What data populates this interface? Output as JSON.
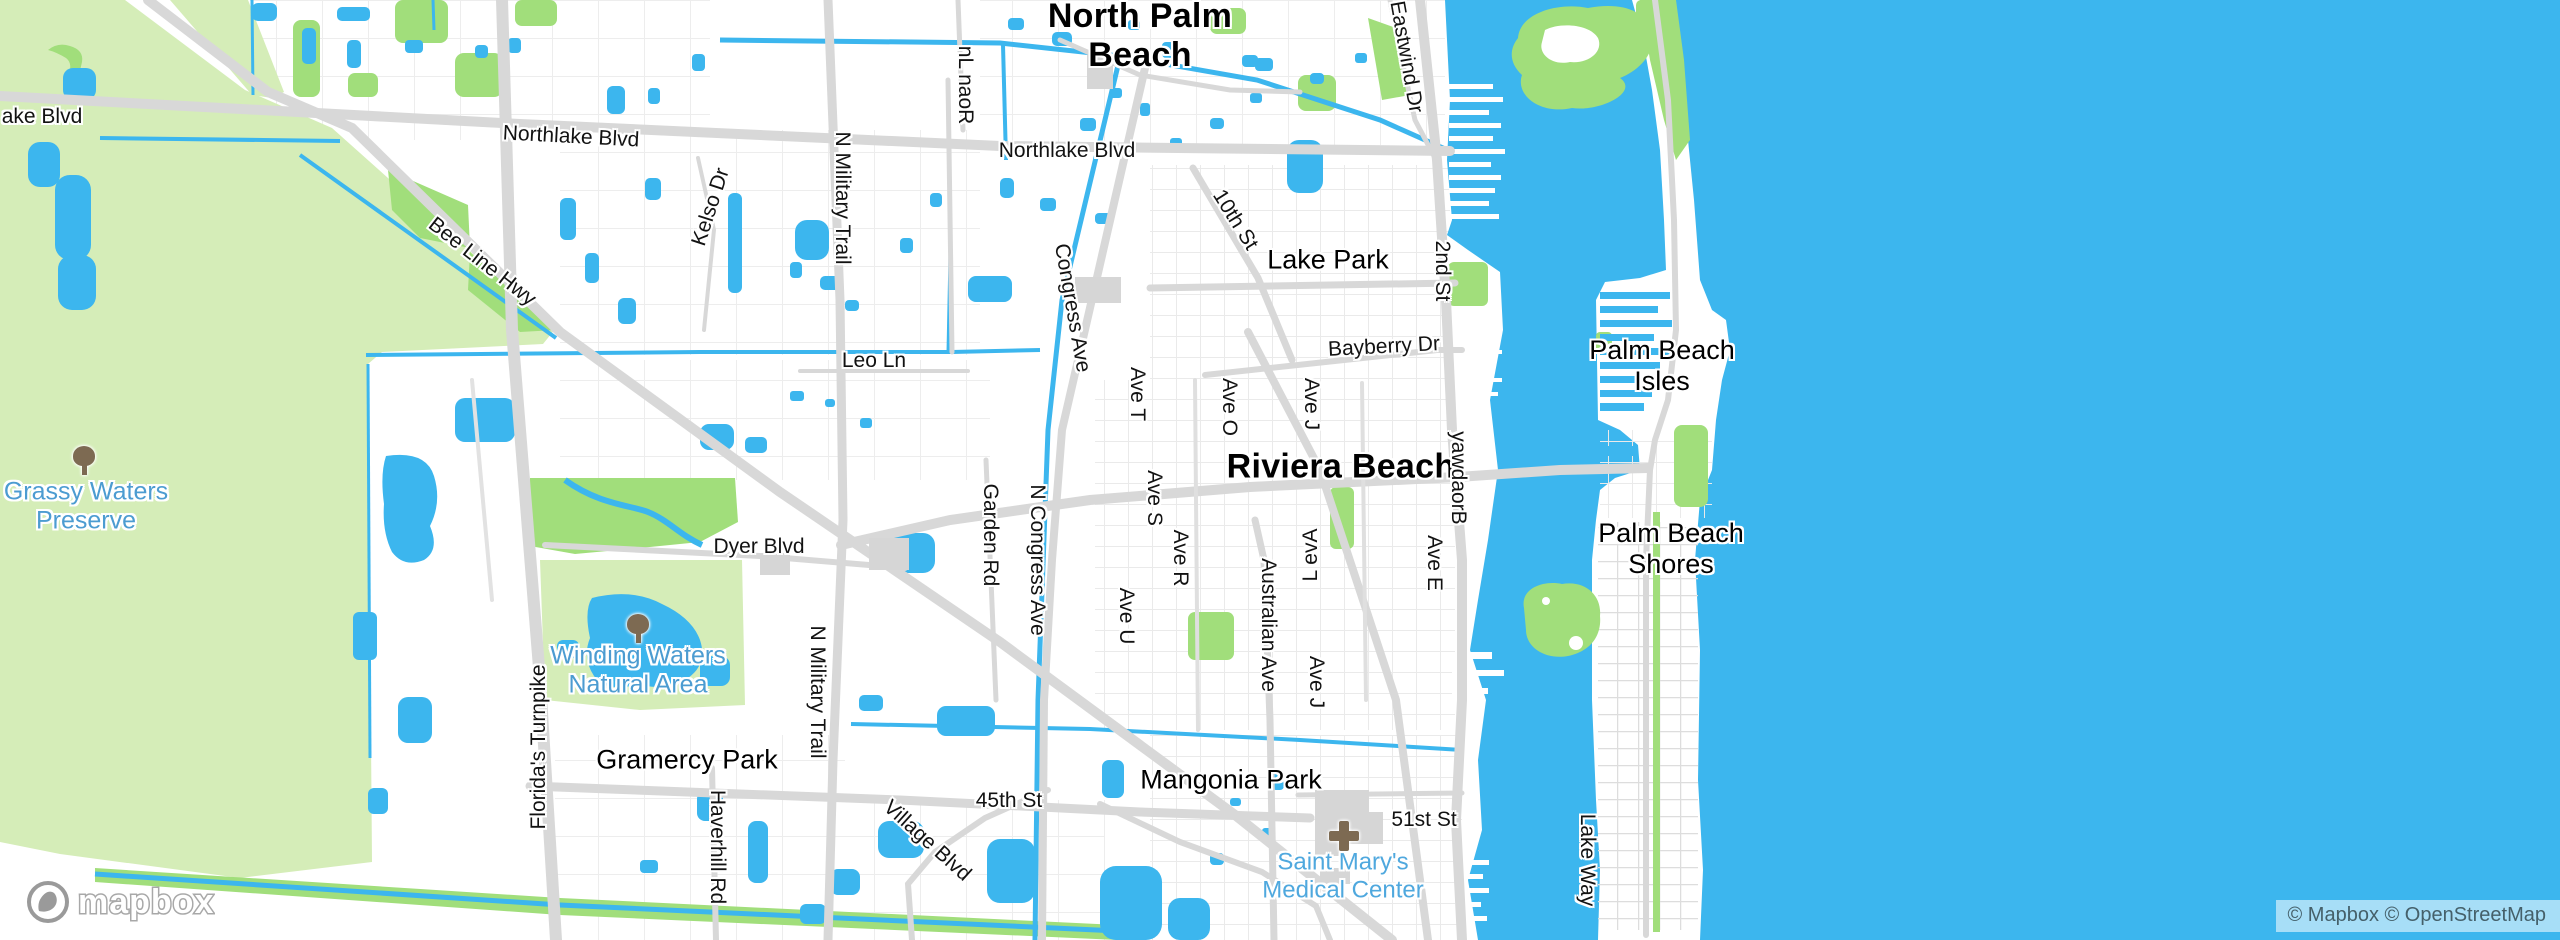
{
  "map": {
    "colors": {
      "water": "#3cb6ee",
      "land": "#ffffff",
      "park_bright": "#a1de7b",
      "park_pale": "#d5edb8",
      "road_major": "#d8d8d8",
      "road_minor": "#eaeaea",
      "building": "#dcdcdc",
      "city_label": "#000000",
      "street_label": "#121212",
      "nature_label": "#4c9cd1",
      "hospital_label": "#4fa8de"
    },
    "logo": {
      "text": "mapbox"
    },
    "attribution": {
      "text": "© Mapbox © OpenStreetMap"
    },
    "icons": [
      {
        "id": "grassy-waters-tree-icon",
        "kind": "tree",
        "x": 84,
        "y": 462
      },
      {
        "id": "winding-waters-tree-icon",
        "kind": "tree",
        "x": 638,
        "y": 630
      },
      {
        "id": "saint-marys-cross-icon",
        "kind": "cross",
        "x": 1344,
        "y": 836
      }
    ],
    "labels": [
      {
        "id": "city-north-palm-beach",
        "type": "city",
        "lines": [
          "North Palm",
          "Beach"
        ],
        "x": 1140,
        "y": 36,
        "rot": 0
      },
      {
        "id": "city-riviera-beach",
        "type": "city",
        "lines": [
          "Riviera Beach"
        ],
        "x": 1341,
        "y": 467,
        "rot": 0
      },
      {
        "id": "town-lake-park",
        "type": "town",
        "lines": [
          "Lake Park"
        ],
        "x": 1328,
        "y": 260,
        "rot": 0
      },
      {
        "id": "town-palm-beach-isles",
        "type": "town",
        "lines": [
          "Palm Beach",
          "Isles"
        ],
        "x": 1662,
        "y": 366,
        "rot": 0
      },
      {
        "id": "town-palm-beach-shores",
        "type": "town",
        "lines": [
          "Palm Beach",
          "Shores"
        ],
        "x": 1671,
        "y": 549,
        "rot": 0
      },
      {
        "id": "town-gramercy-park",
        "type": "town",
        "lines": [
          "Gramercy Park"
        ],
        "x": 687,
        "y": 760,
        "rot": 0
      },
      {
        "id": "town-mangonia-park",
        "type": "town",
        "lines": [
          "Mangonia Park"
        ],
        "x": 1231,
        "y": 780,
        "rot": 0
      },
      {
        "id": "nature-grassy-waters-preserve",
        "type": "nature",
        "lines": [
          "Grassy Waters",
          "Preserve"
        ],
        "x": 86,
        "y": 506,
        "rot": 0
      },
      {
        "id": "nature-winding-waters",
        "type": "nature",
        "lines": [
          "Winding Waters",
          "Natural Area"
        ],
        "x": 638,
        "y": 670,
        "rot": 0
      },
      {
        "id": "poi-saint-marys-medical-center",
        "type": "hospital",
        "lines": [
          "Saint Mary's",
          "Medical Center"
        ],
        "x": 1343,
        "y": 876,
        "rot": 0
      },
      {
        "id": "st-ake-blvd",
        "type": "street",
        "lines": [
          "ake Blvd"
        ],
        "x": 42,
        "y": 117,
        "rot": 0
      },
      {
        "id": "st-northlake-blvd-w",
        "type": "street",
        "lines": [
          "Northlake Blvd"
        ],
        "x": 571,
        "y": 137,
        "rot": 3
      },
      {
        "id": "st-northlake-blvd-e",
        "type": "street",
        "lines": [
          "Northlake Blvd"
        ],
        "x": 1067,
        "y": 151,
        "rot": 0
      },
      {
        "id": "st-bee-line-hwy",
        "type": "street",
        "lines": [
          "Bee Line Hwy"
        ],
        "x": 482,
        "y": 262,
        "rot": 38
      },
      {
        "id": "st-kelso-dr",
        "type": "street",
        "lines": [
          "Kelso Dr"
        ],
        "x": 711,
        "y": 207,
        "rot": -72
      },
      {
        "id": "st-n-military-trail-n",
        "type": "street",
        "lines": [
          "N Military Trail"
        ],
        "x": 842,
        "y": 198,
        "rot": 90
      },
      {
        "id": "st-roan-ln",
        "type": "street",
        "lines": [
          "Roan Ln"
        ],
        "x": 965,
        "y": 85,
        "rot": 90,
        "dir": "up"
      },
      {
        "id": "st-eastwind-dr",
        "type": "street",
        "lines": [
          "Eastwind Dr"
        ],
        "x": 1406,
        "y": 57,
        "rot": 80
      },
      {
        "id": "st-congress-ave",
        "type": "street",
        "lines": [
          "Congress Ave"
        ],
        "x": 1072,
        "y": 308,
        "rot": 80
      },
      {
        "id": "st-10th-st",
        "type": "street",
        "lines": [
          "10th St"
        ],
        "x": 1235,
        "y": 220,
        "rot": 58
      },
      {
        "id": "st-2nd-st",
        "type": "street",
        "lines": [
          "2nd St"
        ],
        "x": 1442,
        "y": 271,
        "rot": 90
      },
      {
        "id": "st-bayberry-dr",
        "type": "street",
        "lines": [
          "Bayberry Dr"
        ],
        "x": 1384,
        "y": 347,
        "rot": -3
      },
      {
        "id": "st-leo-ln",
        "type": "street",
        "lines": [
          "Leo Ln"
        ],
        "x": 874,
        "y": 361,
        "rot": 0
      },
      {
        "id": "st-ave-t",
        "type": "street",
        "lines": [
          "Ave T"
        ],
        "x": 1137,
        "y": 394,
        "rot": 90
      },
      {
        "id": "st-ave-o",
        "type": "street",
        "lines": [
          "Ave O"
        ],
        "x": 1229,
        "y": 407,
        "rot": 90
      },
      {
        "id": "st-ave-j-n",
        "type": "street",
        "lines": [
          "Ave J"
        ],
        "x": 1311,
        "y": 404,
        "rot": 90
      },
      {
        "id": "st-broadway",
        "type": "street",
        "lines": [
          "Broadway"
        ],
        "x": 1458,
        "y": 478,
        "rot": 90,
        "dir": "up"
      },
      {
        "id": "st-ave-s",
        "type": "street",
        "lines": [
          "Ave S"
        ],
        "x": 1154,
        "y": 498,
        "rot": 90
      },
      {
        "id": "st-ave-r",
        "type": "street",
        "lines": [
          "Ave R"
        ],
        "x": 1180,
        "y": 558,
        "rot": 90
      },
      {
        "id": "st-ave-u",
        "type": "street",
        "lines": [
          "Ave U"
        ],
        "x": 1126,
        "y": 616,
        "rot": 90
      },
      {
        "id": "st-ave-l",
        "type": "street",
        "lines": [
          "Ave L"
        ],
        "x": 1311,
        "y": 555,
        "rot": -90,
        "dir": "up"
      },
      {
        "id": "st-ave-e",
        "type": "street",
        "lines": [
          "Ave E"
        ],
        "x": 1434,
        "y": 563,
        "rot": 90
      },
      {
        "id": "st-australian-ave",
        "type": "street",
        "lines": [
          "Australian Ave"
        ],
        "x": 1268,
        "y": 625,
        "rot": 90
      },
      {
        "id": "st-ave-j-s",
        "type": "street",
        "lines": [
          "Ave J"
        ],
        "x": 1316,
        "y": 682,
        "rot": 90
      },
      {
        "id": "st-garden-rd",
        "type": "street",
        "lines": [
          "Garden Rd"
        ],
        "x": 990,
        "y": 535,
        "rot": 90
      },
      {
        "id": "st-n-congress-ave",
        "type": "street",
        "lines": [
          "N Congress Ave"
        ],
        "x": 1037,
        "y": 560,
        "rot": 90
      },
      {
        "id": "st-dyer-blvd",
        "type": "street",
        "lines": [
          "Dyer Blvd"
        ],
        "x": 759,
        "y": 547,
        "rot": 0
      },
      {
        "id": "st-floridas-turnpike",
        "type": "street",
        "lines": [
          "Florida's Turnpike"
        ],
        "x": 539,
        "y": 747,
        "rot": -90
      },
      {
        "id": "st-n-military-trail-s",
        "type": "street",
        "lines": [
          "N Military Trail"
        ],
        "x": 817,
        "y": 692,
        "rot": 90
      },
      {
        "id": "st-45th-st",
        "type": "street",
        "lines": [
          "45th St"
        ],
        "x": 1009,
        "y": 801,
        "rot": 0
      },
      {
        "id": "st-haverhill-rd",
        "type": "street",
        "lines": [
          "Haverhill Rd"
        ],
        "x": 717,
        "y": 847,
        "rot": 90
      },
      {
        "id": "st-village-blvd",
        "type": "street",
        "lines": [
          "Village Blvd"
        ],
        "x": 927,
        "y": 841,
        "rot": 42
      },
      {
        "id": "st-51st-st",
        "type": "street",
        "lines": [
          "51st St"
        ],
        "x": 1424,
        "y": 820,
        "rot": 0
      },
      {
        "id": "st-lake-way",
        "type": "street",
        "lines": [
          "Lake Way"
        ],
        "x": 1587,
        "y": 860,
        "rot": 90
      }
    ]
  }
}
